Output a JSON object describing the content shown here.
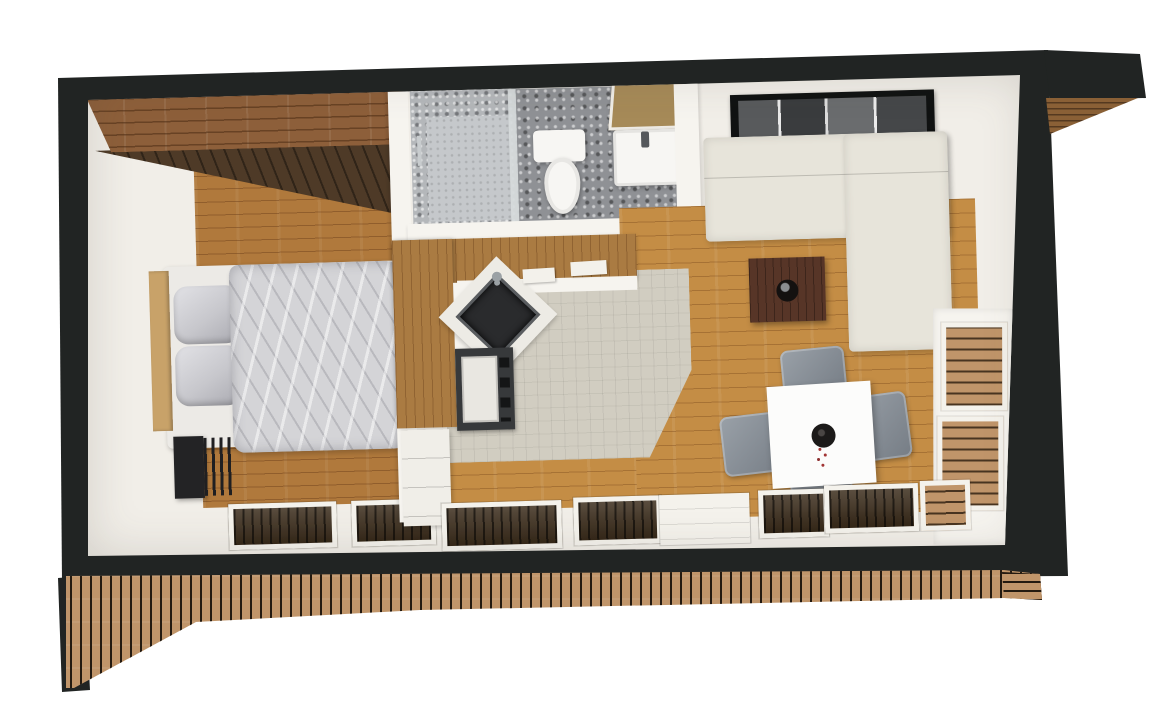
{
  "scene": {
    "title": "Top-down 3D render of a small one-bedroom cabin floor plan",
    "type": "architectural-3d-floor-plan",
    "camera_view": "top-down",
    "background": "#ffffff"
  },
  "rooms": [
    {
      "id": "bedroom",
      "label": "Bedroom",
      "furniture": [
        "double bed with grey duvet",
        "two silver pillows",
        "light wood headboard",
        "black open wardrobe with hangers",
        "wood loft beam and sloped dark ceiling",
        "two windows in south wall"
      ]
    },
    {
      "id": "bathroom",
      "label": "Bathroom",
      "furniture": [
        "walk-in stone shower with glass panel",
        "white toilet",
        "white vanity basin with tan mirror",
        "grey pebble tile floor",
        "wood step stool at doorway"
      ]
    },
    {
      "id": "kitchen",
      "label": "Kitchen",
      "furniture": [
        "L-shaped wood worktop",
        "black corner sink with faucet",
        "oven with white front and knobs",
        "white drawer cabinets",
        "two white serving boards"
      ]
    },
    {
      "id": "living-room",
      "label": "Living room",
      "furniture": [
        "L-shaped cream corner sofa",
        "dark wood coffee table with round bowl",
        "wall-mounted widescreen TV"
      ]
    },
    {
      "id": "dining-area",
      "label": "Dining area",
      "furniture": [
        "white square dining table",
        "black vase with red sprig",
        "four grey upholstered chairs"
      ]
    },
    {
      "id": "exterior",
      "label": "Exterior",
      "furniture": [
        "black wall shell",
        "roof overhang with wood slat soffit",
        "vertical wood slat facade band",
        "side deck openings with wood slats",
        "entrance door in south wall"
      ]
    }
  ],
  "colors": {
    "wall_black": "#212423",
    "interior_white": "#f1eee8",
    "wall_face": "#f6f4ef",
    "beam_wood": "#8d5f3a",
    "slope_wood": "#4e3a27",
    "floor_bedroom": "#b0793c",
    "floor_living": "#c48d45",
    "counter_wood": "#aa7b42",
    "deck_slat": "#c0956a",
    "deck_gap": "#241a10",
    "soffit_wood": "#8a6036",
    "tile_kitchen": "#d1cdc1",
    "pebble_gray": "#8f9195",
    "stone_gray": "#b4b7ba",
    "shower_floor": "#c5c8cb",
    "sofa_cream": "#e7e4da",
    "coffee_brown": "#573527",
    "chair_gray": "#868d95",
    "table_white": "#fcfcfb",
    "duvet_gray": "#d4d4d7",
    "pillow_silver": "#c7c7cc",
    "mattress_white": "#eceae6",
    "headboard_wood": "#c8a269",
    "wardrobe_black": "#232325",
    "sink_black": "#2a2b2d",
    "stove_gray": "#37393b",
    "vanity_tan": "#a68a58",
    "window_dark": "#3a2b1a",
    "frame_white": "#f4f2ec",
    "porcelain": "#f7f6f3"
  }
}
